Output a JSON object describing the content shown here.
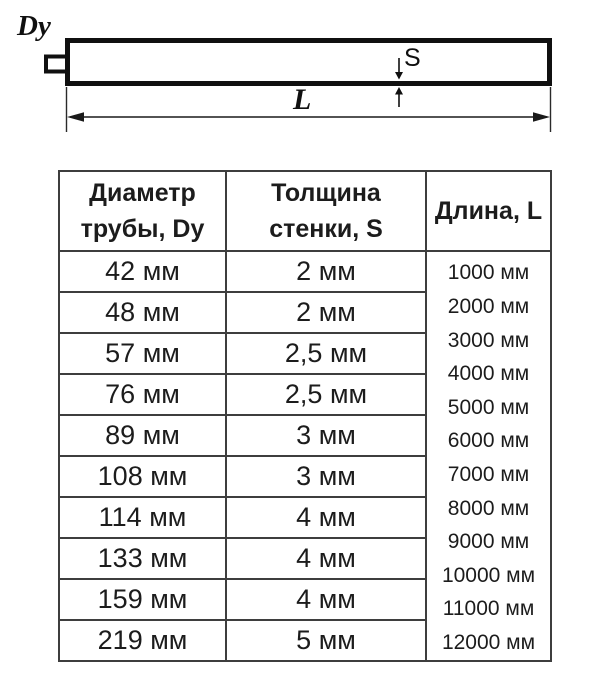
{
  "diagram": {
    "dy_label": "Dy",
    "s_label": "S",
    "l_label": "L"
  },
  "table": {
    "headers": [
      {
        "line1": "Диаметр",
        "line2": "трубы, Dy"
      },
      {
        "line1": "Толщина",
        "line2": "стенки, S"
      },
      {
        "line1": "Длина, L"
      }
    ],
    "rows": [
      {
        "diameter": "42 мм",
        "thickness": "2 мм"
      },
      {
        "diameter": "48 мм",
        "thickness": "2 мм"
      },
      {
        "diameter": "57 мм",
        "thickness": "2,5 мм"
      },
      {
        "diameter": "76 мм",
        "thickness": "2,5 мм"
      },
      {
        "diameter": "89 мм",
        "thickness": "3 мм"
      },
      {
        "diameter": "108 мм",
        "thickness": "3 мм"
      },
      {
        "diameter": "114 мм",
        "thickness": "4 мм"
      },
      {
        "diameter": "133 мм",
        "thickness": "4 мм"
      },
      {
        "diameter": "159 мм",
        "thickness": "4 мм"
      },
      {
        "diameter": "219 мм",
        "thickness": "5 мм"
      }
    ],
    "lengths": [
      "1000 мм",
      "2000 мм",
      "3000 мм",
      "4000 мм",
      "5000 мм",
      "6000 мм",
      "7000 мм",
      "8000 мм",
      "9000 мм",
      "10000 мм",
      "11000 мм",
      "12000 мм"
    ]
  },
  "colors": {
    "drawing_line": "#101010",
    "table_border": "#3e3e3e",
    "text": "#1c1c1c",
    "background": "#ffffff"
  }
}
